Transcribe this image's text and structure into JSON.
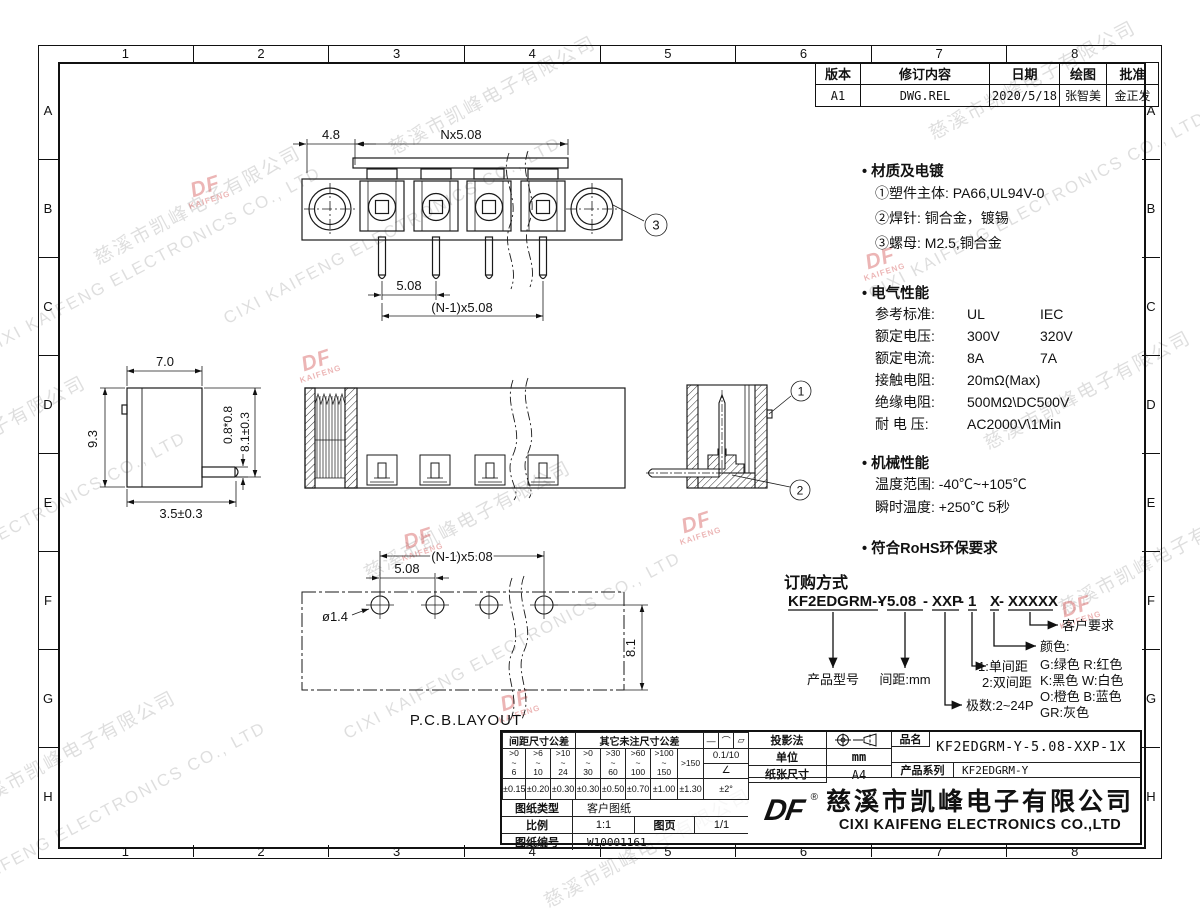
{
  "frame": {
    "cols": [
      "1",
      "2",
      "3",
      "4",
      "5",
      "6",
      "7",
      "8"
    ],
    "rows": [
      "A",
      "B",
      "C",
      "D",
      "E",
      "F",
      "G",
      "H"
    ]
  },
  "revision": {
    "h_version": "版本",
    "h_content": "修订内容",
    "h_date": "日期",
    "h_draw": "绘图",
    "h_approve": "批准",
    "version": "A1",
    "content": "DWG.REL",
    "date": "2020/5/18",
    "draw": "张智美",
    "approve": "金正发"
  },
  "front_view": {
    "dim_a": "4.8",
    "dim_b": "Nx5.08",
    "dim_c": "5.08",
    "dim_d": "(N-1)x5.08",
    "callout": "3"
  },
  "side_view": {
    "dim_w": "7.0",
    "dim_h": "9.3",
    "dim_pin": "0.8*0.8",
    "dim_len": "8.1±0.3",
    "dim_off": "3.5±0.3"
  },
  "section_view": {
    "callout1": "1",
    "callout2": "2"
  },
  "pcb_view": {
    "dim_hole": "ø1.4",
    "dim_pitch": "5.08",
    "dim_span": "(N-1)x5.08",
    "dim_depth": "8.1",
    "label": "P.C.B.LAYOUT"
  },
  "specs": {
    "material_title": "材质及电镀",
    "material_lines": [
      "①塑件主体: PA66,UL94V-0",
      "②焊针: 铜合金，镀锡",
      "③螺母: M2.5,铜合金"
    ],
    "electrical_title": "电气性能",
    "electrical_rows": [
      {
        "label": "参考标准:",
        "v1": "UL",
        "v2": "IEC"
      },
      {
        "label": "额定电压:",
        "v1": "300V",
        "v2": "320V"
      },
      {
        "label": "额定电流:",
        "v1": "8A",
        "v2": "7A"
      },
      {
        "label": "接触电阻:",
        "v1": "20mΩ(Max)",
        "v2": ""
      },
      {
        "label": "绝缘电阻:",
        "v1": "500MΩ\\DC500V",
        "v2": ""
      },
      {
        "label": "耐 电 压:",
        "v1": "AC2000V\\1Min",
        "v2": ""
      }
    ],
    "mechanical_title": "机械性能",
    "mechanical_lines": [
      "温度范围: -40℃~+105℃",
      "瞬时温度: +250℃  5秒"
    ],
    "rohs": "符合RoHS环保要求"
  },
  "ordering": {
    "title": "订购方式",
    "pn_base": "KF2EDGRM-Y",
    "sep": "-",
    "pn_pitch": "5.08",
    "pn_poles": "XXP",
    "pn_row": "1",
    "pn_color": "X",
    "pn_custom": "XXXXX",
    "label_model": "产品型号",
    "label_pitch": "间距:mm",
    "label_poles": "极数:2~24P",
    "label_row1": "1:单间距",
    "label_row2": "2:双间距",
    "label_custom": "客户要求",
    "label_color": "颜色:",
    "color_lines": [
      "G:绿色  R:红色",
      "K:黑色  W:白色",
      "O:橙色  B:蓝色",
      "GR:灰色"
    ]
  },
  "tol": {
    "group1": "间距尺寸公差",
    "group2": "其它未注尺寸公差",
    "ranges": [
      ">0\n~\n6",
      ">6\n~\n10",
      ">10\n~\n24",
      ">0\n~\n30",
      ">30\n~\n60",
      ">60\n~\n100",
      ">100\n~\n150",
      ">150"
    ],
    "tols": [
      "±0.15",
      "±0.20",
      "±0.30",
      "±0.30",
      "±0.50",
      "±0.70",
      "±1.00",
      "±1.30"
    ],
    "sym1": "—",
    "sym2": "⌒",
    "sym3": "▱",
    "sym_val": "0.1/10",
    "sym_angle": "∠",
    "sym_angle_tol": "±2°"
  },
  "tb": {
    "projection_label": "投影法",
    "unit_label": "单位",
    "unit_value": "mm",
    "paper_label": "纸张尺寸",
    "paper_value": "A4",
    "name_label": "品名",
    "name_value": "KF2EDGRM-Y-5.08-XXP-1X",
    "series_label": "产品系列",
    "series_value": "KF2EDGRM-Y",
    "type_label": "图纸类型",
    "type_value": "客户图纸",
    "scale_label": "比例",
    "scale_value": "1:1",
    "page_label": "图页",
    "page_value": "1/1",
    "number_label": "图纸编号",
    "number_value": "W10001161",
    "logo_text": "DF",
    "registered": "®",
    "company_cn": "慈溪市凯峰电子有限公司",
    "company_en": "CIXI KAIFENG ELECTRONICS CO.,LTD"
  },
  "watermark": {
    "en": "CIXI KAIFENG ELECTRONICS CO., LTD",
    "cn": "慈溪市凯峰电子有限公司",
    "logo_top": "DF",
    "logo_bottom": "KAIFENG"
  }
}
